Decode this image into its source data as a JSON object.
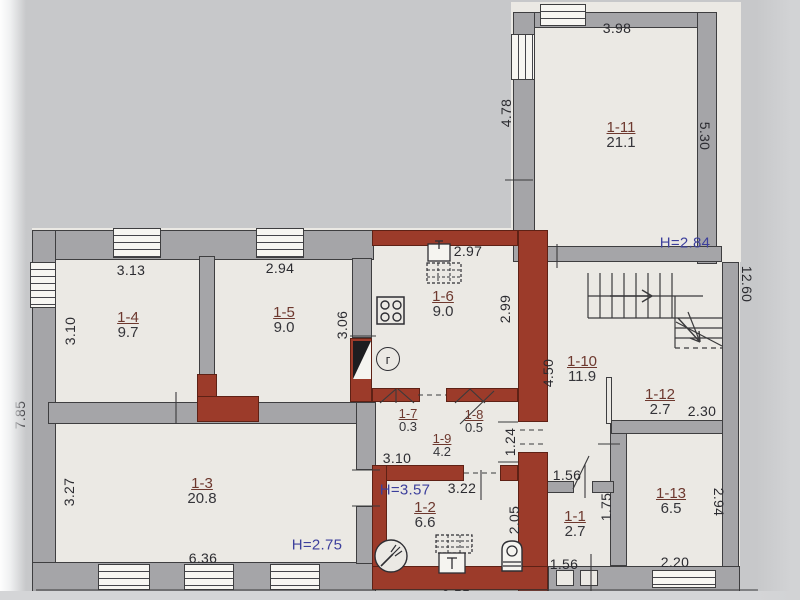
{
  "document": {
    "kind": "apartment-floor-plan-photo"
  },
  "colors": {
    "background": "#c7c8ca",
    "paper": "#ebe9e4",
    "wall_gray": "#a5a5a8",
    "wall_brick_red": "#9c3b2a",
    "dimension_text": "#2b2b30",
    "room_number_text": "#6d382e",
    "ceiling_height_text": "#3c3f9c"
  },
  "rooms": {
    "r11": {
      "id": "1-11",
      "area": "21.1"
    },
    "r4": {
      "id": "1-4",
      "area": "9.7"
    },
    "r5": {
      "id": "1-5",
      "area": "9.0"
    },
    "r6": {
      "id": "1-6",
      "area": "9.0"
    },
    "r7": {
      "id": "1-7",
      "area": "0.3"
    },
    "r8": {
      "id": "1-8",
      "area": "0.5"
    },
    "r9": {
      "id": "1-9",
      "area": "4.2"
    },
    "r10": {
      "id": "1-10",
      "area": "11.9"
    },
    "r12": {
      "id": "1-12",
      "area": "2.7"
    },
    "r3": {
      "id": "1-3",
      "area": "20.8"
    },
    "r2": {
      "id": "1-2",
      "area": "6.6"
    },
    "r1": {
      "id": "1-1",
      "area": "2.7"
    },
    "r13": {
      "id": "1-13",
      "area": "6.5"
    }
  },
  "heights": {
    "r11": "H=2.84",
    "r2": "H=3.57",
    "r3": "H=2.75"
  },
  "dims": {
    "top_r11": "3.98",
    "left_r11": "4.78",
    "right_r11": "5.30",
    "right_total": "12.60",
    "top_r4": "3.13",
    "top_r5": "2.94",
    "left_r4": "3.10",
    "right_r5": "3.06",
    "left_total": "7.85",
    "top_r6": "2.97",
    "right_r6": "2.99",
    "left_r10": "4.50",
    "width_r9": "3.10",
    "gap_r8": "1.24",
    "top_r2": "3.22",
    "right_r2": "2.05",
    "left_r3": "3.27",
    "bottom_r3": "6.36",
    "top_r1": "1.56",
    "right_r1": "1.75",
    "bottom_r1": "1.56",
    "bottom_r12": "2.30",
    "right_r13": "2.94",
    "bottom_r13": "2.20",
    "bottom_r2_total": "3.55",
    "bottom_right_total": "4.30"
  },
  "icons": {
    "gas_meter_label": "г",
    "stove": "stove-4-burners",
    "sink": "kitchen-sink",
    "vent_kitchen": "vent-hatch-grid",
    "shower": "shower-drain",
    "toilet": "toilet",
    "boiler": "water-heater",
    "vent_bath": "vent-hatch-grid",
    "stairs": "staircase-with-up-arrow",
    "door": "door-leaf-black-triangle"
  }
}
